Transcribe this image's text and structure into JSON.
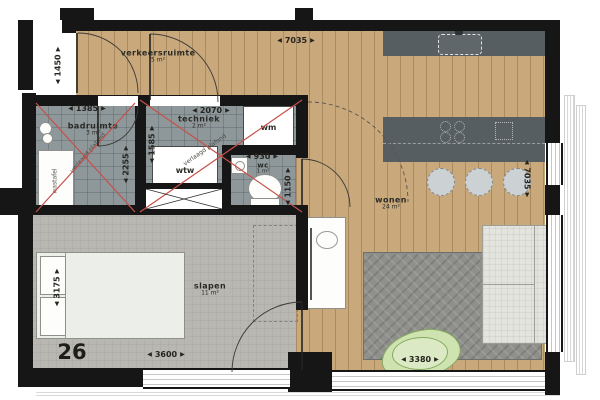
{
  "plan_title": "apartment floor plan",
  "apartment": {
    "number": "26"
  },
  "rooms": {
    "verkeersruimte": {
      "name": "verkeersruimte",
      "area": "5 m²"
    },
    "badruimte": {
      "name": "badruimte",
      "area": "3 m²"
    },
    "techniek": {
      "name": "techniek",
      "area": "2 m²"
    },
    "wc": {
      "name": "wc",
      "area": "1 m²"
    },
    "slapen": {
      "name": "slapen",
      "area": "11 m²"
    },
    "wonen": {
      "name": "wonen",
      "area": "24 m²"
    }
  },
  "fixtures": {
    "washing_machine": "wm",
    "heat_recovery_unit": "wtw",
    "washbasin": "wastafel"
  },
  "notes": {
    "ceiling_note": "verlaagd plafond"
  },
  "ui": {
    "arrow_left": "◀",
    "arrow_right": "▶",
    "arrow_up": "▲",
    "arrow_down": "▼"
  },
  "dimensions": {
    "top_width": "7035",
    "hall_depth": "1450",
    "bath_width": "1385",
    "bath_depth": "2255",
    "tech_width": "2070",
    "tech_depth": "1585",
    "wc_width": "930",
    "wc_depth": "1150",
    "bedroom_depth": "3175",
    "bedroom_width": "3600",
    "living_depth": "7035",
    "rug_width": "3380"
  },
  "colors": {
    "wall": "#161616",
    "wood": "#c9a87c",
    "tile": "#8e989b",
    "carpet": "#b8b7b2",
    "counter": "#565e61",
    "red": "#c6504a",
    "rug": "#8f8f8c",
    "plant": "#cfe3b0",
    "plantline": "#84aa60",
    "dim": "#26241f"
  }
}
